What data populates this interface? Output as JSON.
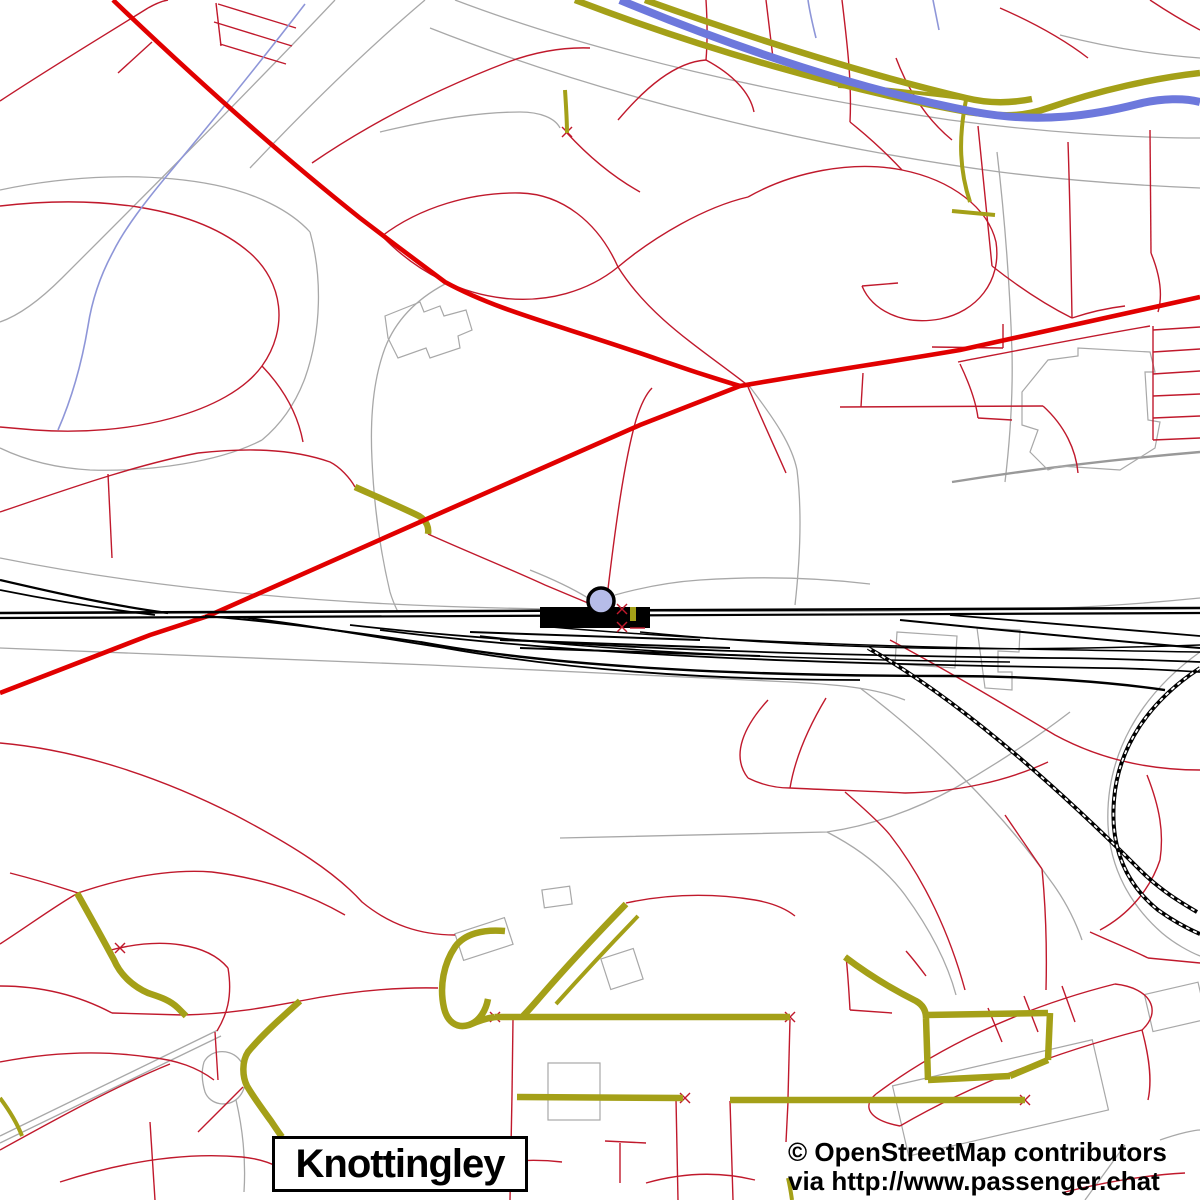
{
  "map": {
    "title_label": "Knottingley",
    "attribution": {
      "line1": "© OpenStreetMap contributors",
      "line2": "via http://www.passenger.chat"
    },
    "station_marker": "railway-station",
    "colors": {
      "background": "#ffffff",
      "major_road": "#e10000",
      "minor_road": "#c0192c",
      "tertiary_road": "#a4a018",
      "water": "#6d78dc",
      "stream": "#8e96d8",
      "path_gray": "#a8a8a8",
      "wide_gray": "#999999",
      "railway": "#000000",
      "marker_fill": "#b6bce8",
      "label_text": "#000000"
    }
  }
}
